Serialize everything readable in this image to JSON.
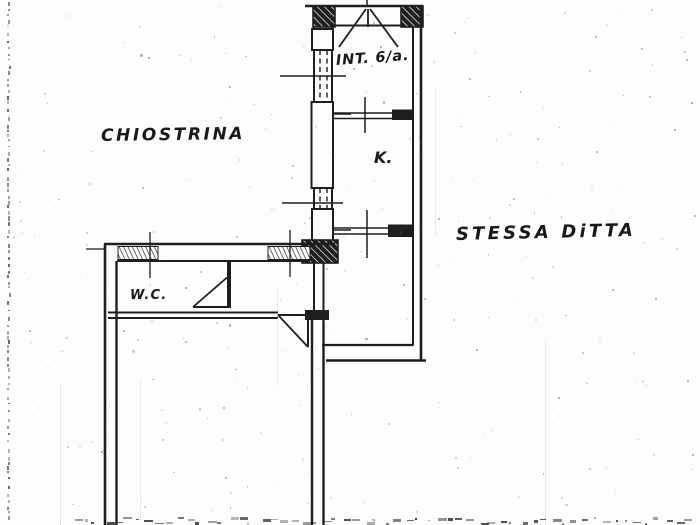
{
  "labels": {
    "chiostrina": "CHIOSTRINA",
    "int_unit": "INT. 6/a.",
    "kitchen": "K.",
    "wc": "W.C.",
    "stessa_ditta": "STESSA DiTTA"
  },
  "colors": {
    "ink": "#1e1e1c",
    "paper": "#fdfdfb",
    "noise": "#8a8a84"
  }
}
